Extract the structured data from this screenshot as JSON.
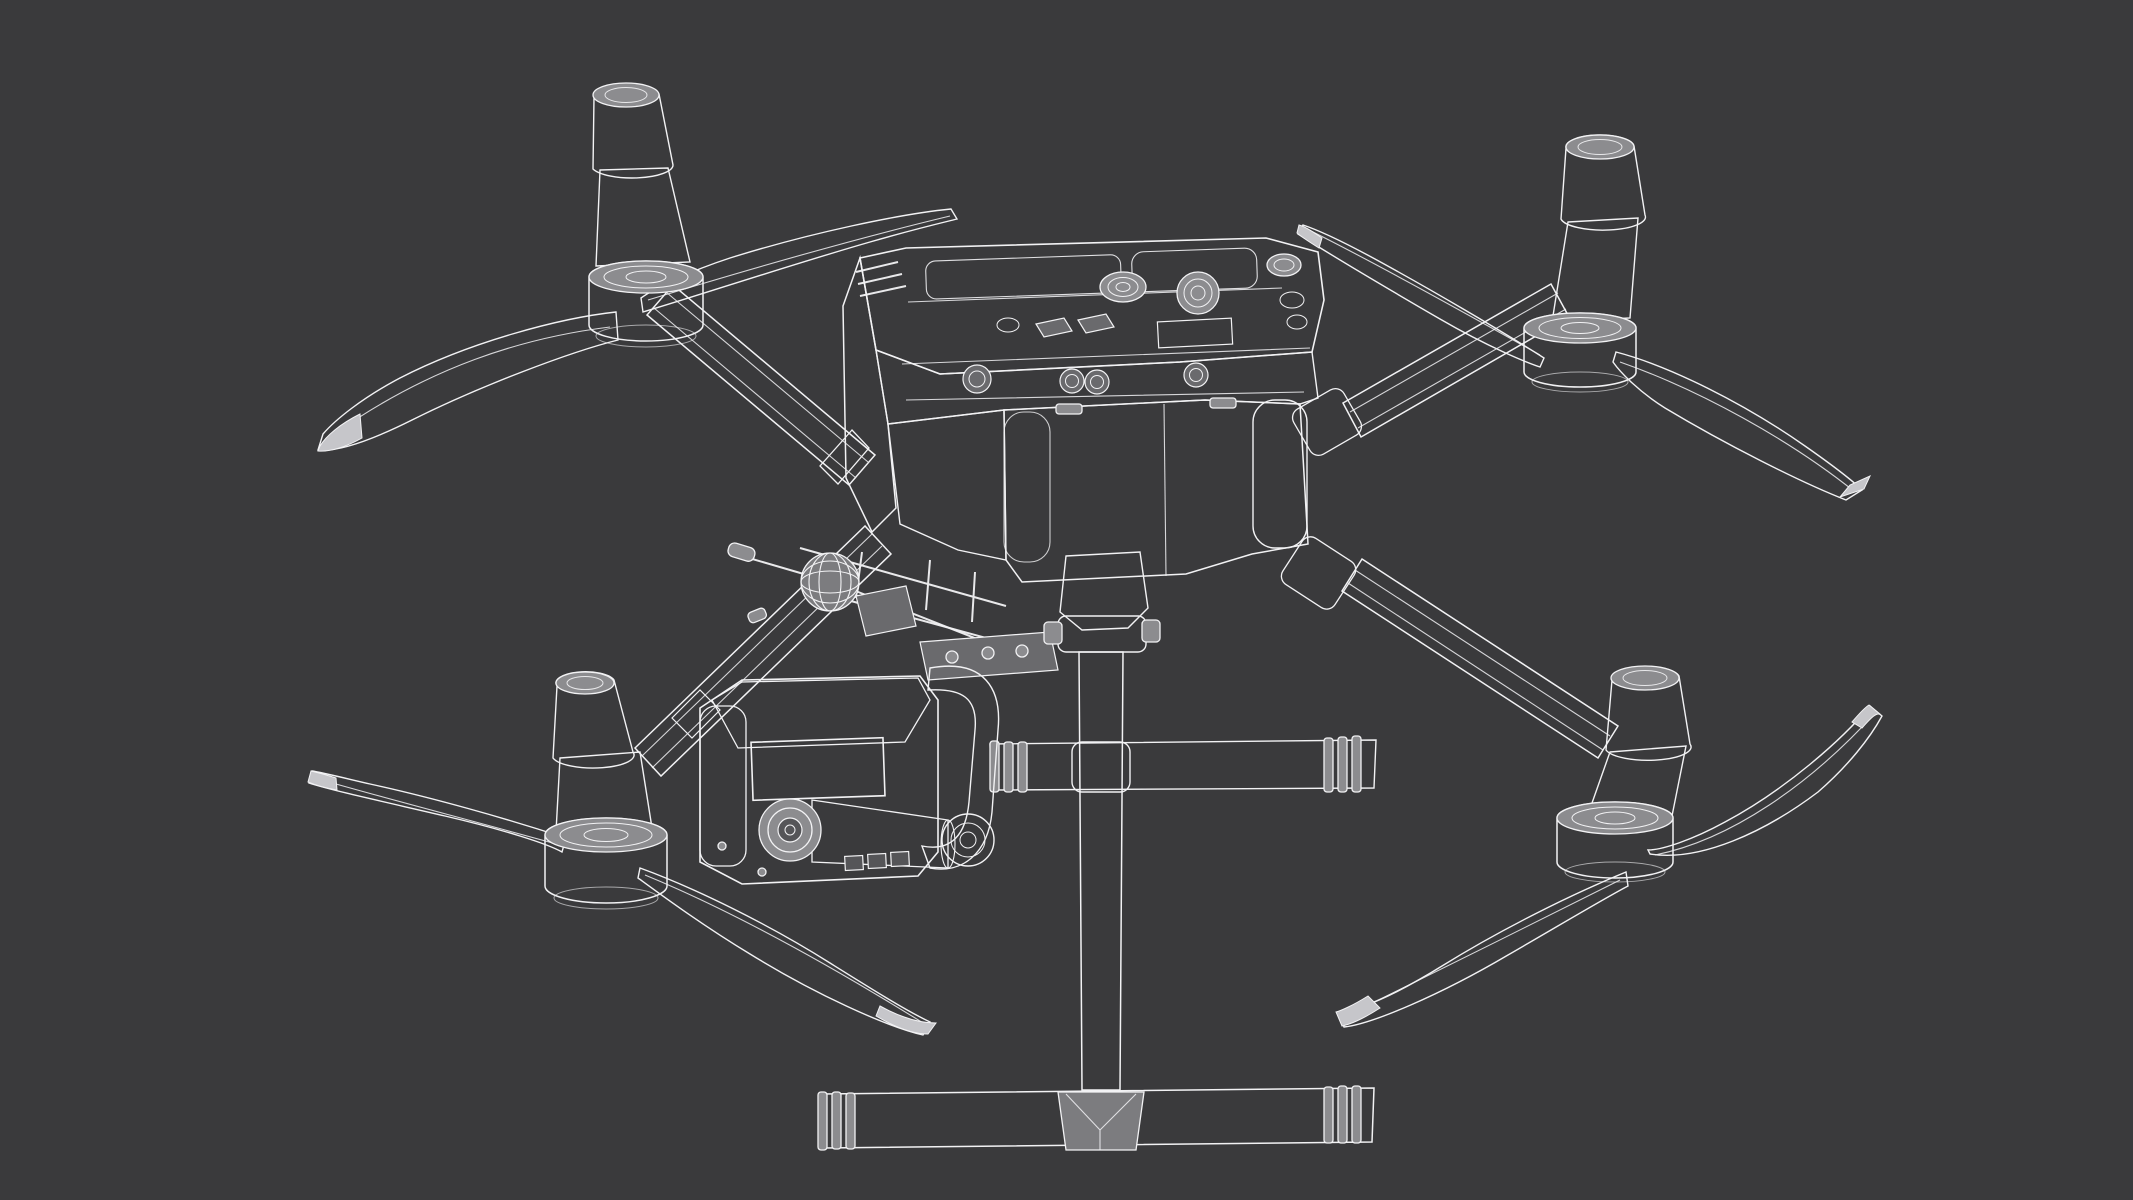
{
  "scene": {
    "title": "3D wireframe render of a quadcopter drone with folded landing gear, top front three-quarter view",
    "style": "white polygon-mesh wireframe over gray shaded surfaces on a dark charcoal background",
    "visible_text": ""
  },
  "colors": {
    "bg": "#3a3a3c",
    "wire": "#f2f2f4",
    "s1": "#8c8c8f",
    "s2": "#7c7c7f",
    "s3": "#6a6a6d",
    "s4": "#555558"
  },
  "parts": {
    "root": {
      "label": "drone-wireframe-render"
    },
    "body": {
      "label": "center fuselage with battery bay, GPS dome and cooling fan"
    },
    "top_deck": {
      "label": "top deck panel"
    },
    "gps_dome": {
      "label": "GPS dome"
    },
    "fan": {
      "label": "cooling fan vent"
    },
    "battery": {
      "label": "battery compartment"
    },
    "arm_tl": {
      "label": "rear-left arm"
    },
    "arm_tr": {
      "label": "rear-right arm"
    },
    "arm_bl": {
      "label": "front-left arm"
    },
    "arm_br": {
      "label": "front-right arm"
    },
    "motor_tl": {
      "label": "rear-left motor with antenna cone"
    },
    "motor_tr": {
      "label": "rear-right motor with antenna cone"
    },
    "motor_bl": {
      "label": "front-left motor with antenna cone"
    },
    "motor_br": {
      "label": "front-right motor with antenna cone"
    },
    "props": {
      "label": "folded propeller blades"
    },
    "gimbal": {
      "label": "camera gimbal payload with ribbed heatsink and lens"
    },
    "lens": {
      "label": "camera lens"
    },
    "antenna": {
      "label": "antenna ball and rods"
    },
    "gear": {
      "label": "landing gear mast and skids"
    },
    "skid_front": {
      "label": "front landing skid tube"
    },
    "skid_rear": {
      "label": "rear landing skid tube"
    }
  }
}
